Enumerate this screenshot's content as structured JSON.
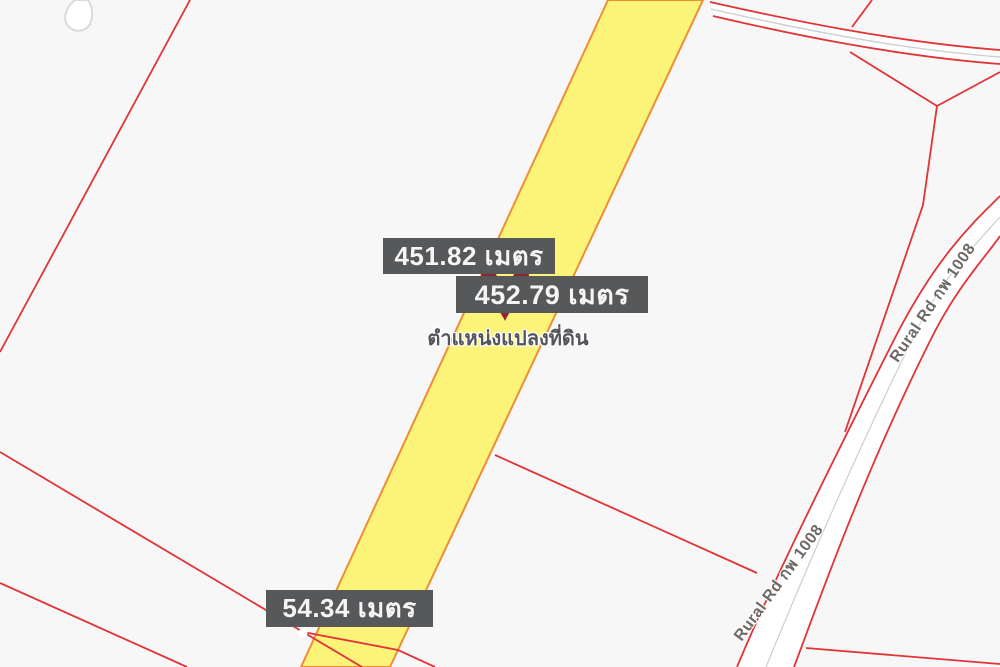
{
  "map": {
    "labels": {
      "measurement_top": "451.82 เมตร",
      "measurement_middle": "452.79 เมตร",
      "measurement_bottom": "54.34 เมตร",
      "marker_caption": "ตำแหน่งแปลงที่ดิน",
      "road_name": "Rural Rd กพ 1008"
    },
    "colors": {
      "background": "#f7f7f8",
      "parcel_line": "#e23336",
      "highlight_fill": "#fcf478",
      "highlight_border": "#ee8e35",
      "label_background": "#57585a",
      "label_text": "#f5f5f5",
      "marker_pin": "#8e2433",
      "road_fill": "#ffffff",
      "road_casing": "#d9dade",
      "road_centerline": "#cdced2",
      "road_label_text": "#6e6965",
      "caption_text": "#54555a"
    }
  }
}
